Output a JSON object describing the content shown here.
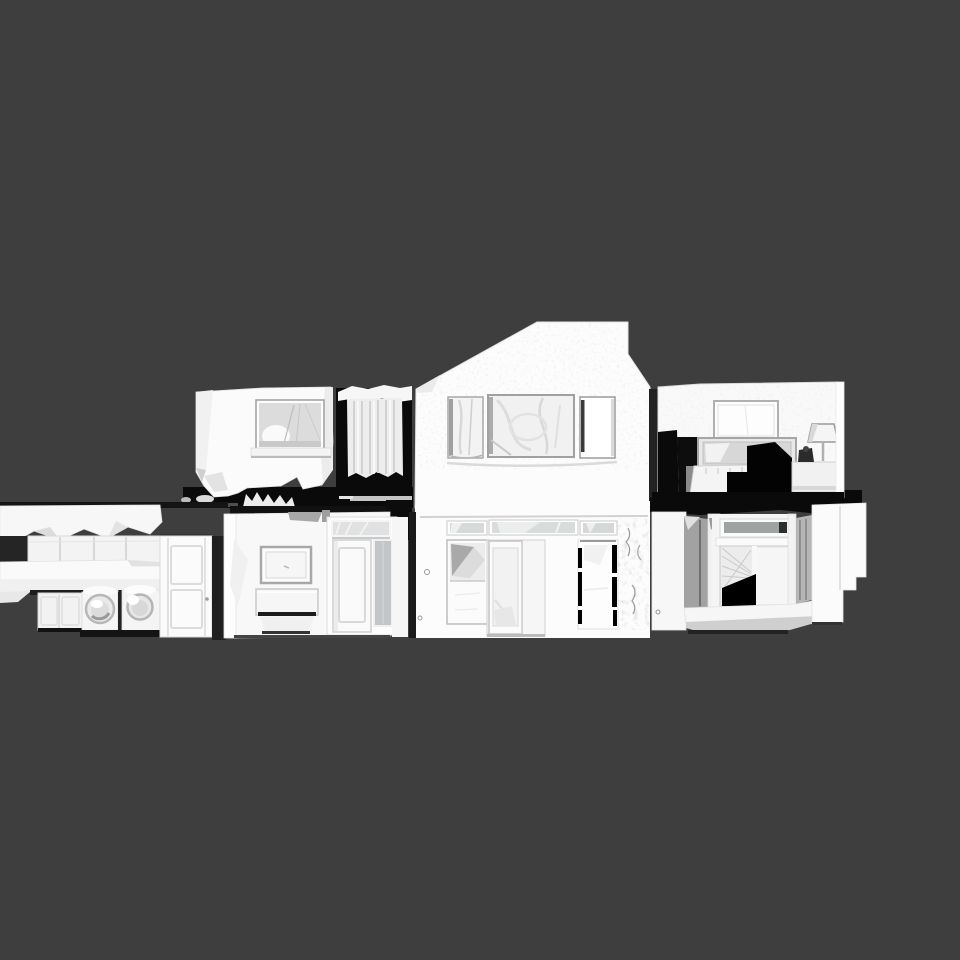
{
  "scene": {
    "description": "3D scanned house model shown as a front cutaway elevation on a plain dark viewport",
    "view": "front-elevation-cutaway",
    "floors": [
      "upper-floor",
      "ground-floor"
    ],
    "model_parts": {
      "upper_left_room": "upper bedroom block with window",
      "curtain_unit": "curtained opening",
      "gable_section": "central gabled facade with three windows",
      "bedroom_section": "cutaway bedroom with picture frame, bed and lamp",
      "laundry_section": "laundry room with cabinets, counter, washer, dryer and door",
      "entry_section": "entry hall with mirror, console table and interior door",
      "front_entrance": "front entrance with transom windows, side windows and double door",
      "bay_window_section": "bay window with angled side panels"
    }
  },
  "palette": {
    "background": "#3e3e3e",
    "mesh-white": "#fafafa",
    "mesh-light": "#efefef",
    "mesh-mid": "#cfcfcf",
    "glass-gray": "#d6d9da",
    "panel-gray": "#a2a2a2",
    "shadow-black": "#0a0a0a"
  }
}
